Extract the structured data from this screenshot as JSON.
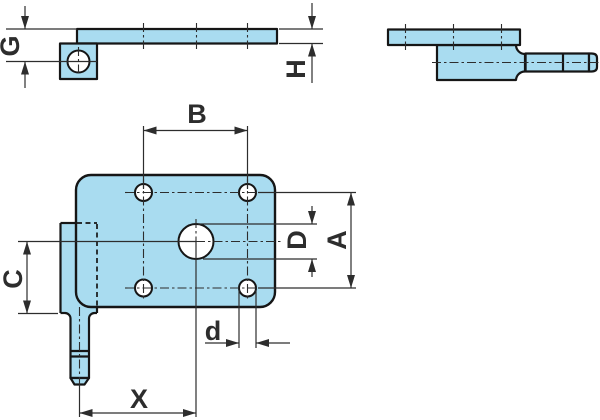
{
  "drawing": {
    "background": "#ffffff",
    "part_fill": "#a9dcf0",
    "outline_color": "#161616",
    "dim_color": "#2d2d2d",
    "label_color": "#2d2d2d",
    "dimension_labels": {
      "G": "G",
      "H": "H",
      "B": "B",
      "D": "D",
      "A": "A",
      "C": "C",
      "d": "d",
      "X": "X"
    }
  }
}
